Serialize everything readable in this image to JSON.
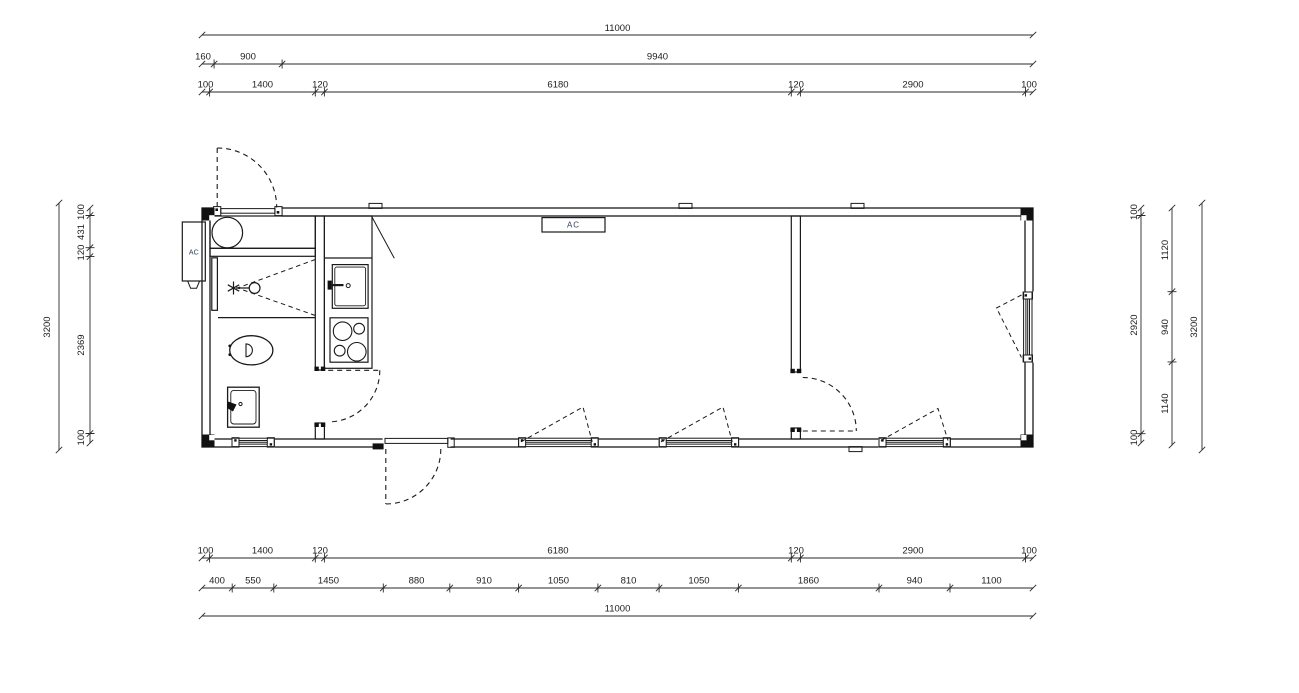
{
  "drawing": {
    "type": "floor-plan",
    "units": "mm"
  },
  "dims": {
    "top": {
      "overall": "11000",
      "row2": [
        "160",
        "900",
        "9940"
      ],
      "row3": [
        "100",
        "1400",
        "120",
        "6180",
        "120",
        "2900",
        "100"
      ]
    },
    "bottom": {
      "row1": [
        "100",
        "1400",
        "120",
        "6180",
        "120",
        "2900",
        "100"
      ],
      "row2": [
        "400",
        "550",
        "1450",
        "880",
        "910",
        "1050",
        "810",
        "1050",
        "1860",
        "940",
        "1100"
      ],
      "overall": "11000"
    },
    "left": {
      "overall": "3200",
      "chain": [
        "100",
        "431",
        "120",
        "2369",
        "100"
      ]
    },
    "right": {
      "chain1": [
        "100",
        "2920",
        "100"
      ],
      "chain2": [
        "1120",
        "940",
        "1140"
      ],
      "overall": "3200"
    }
  },
  "labels": {
    "wall_ac_unit": "AC",
    "ceiling_ac_unit": "AC"
  },
  "colors": {
    "line": "#1a1a1a",
    "dim_line": "#2a2a2a",
    "ac_text": "#2b3f5c"
  }
}
